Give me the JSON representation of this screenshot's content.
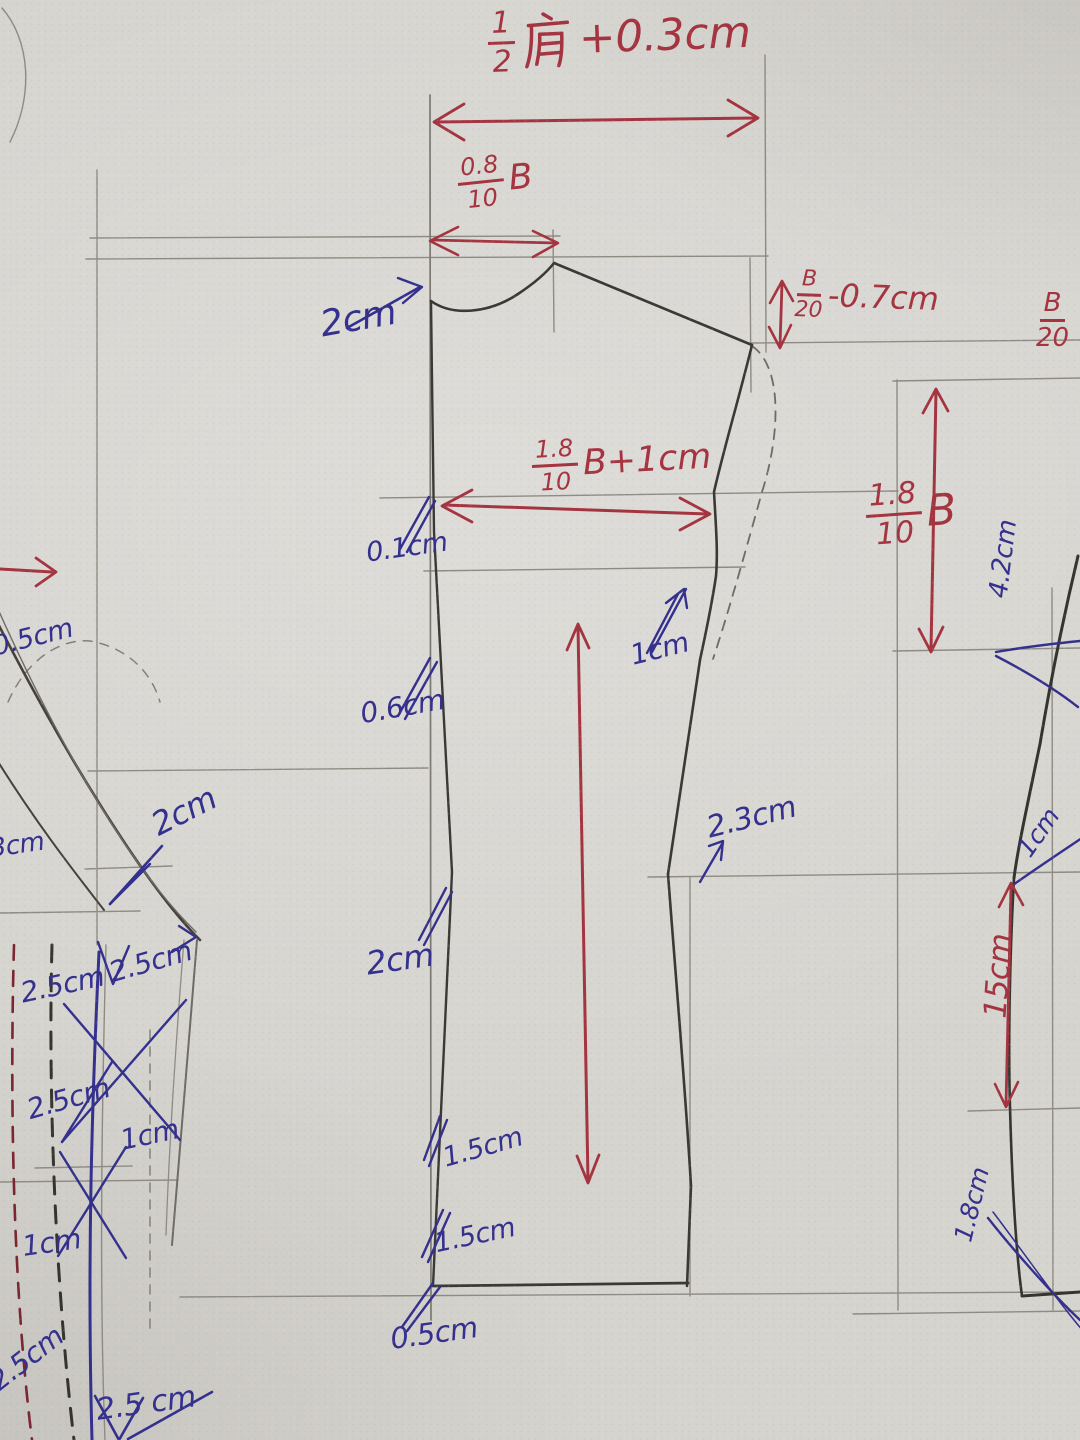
{
  "palette": {
    "paper": "#d6d4cf",
    "pencil_bold": "#3b3936",
    "pencil_light": "#8f8b84",
    "red_ink": "#a43440",
    "blue_ink": "#34308d"
  },
  "formulas": {
    "half_shoulder": {
      "num": "1",
      "den": "2",
      "kanji": "肩",
      "suffix": "+0.3cm"
    },
    "back_neck_rise": {
      "num": "0.8",
      "den": "10",
      "suffix": "B"
    },
    "shoulder_slope": {
      "num": "B",
      "den": "20",
      "suffix": "-0.7cm"
    },
    "edge_partial": {
      "num": "B",
      "den": "20",
      "suffix": ""
    },
    "half_chest": {
      "num": "1.8",
      "den": "10",
      "suffix": "B+1cm"
    },
    "armhole_depth": {
      "num": "1.8",
      "den": "10",
      "suffix": "B"
    }
  },
  "labels": [
    {
      "text": "2cm",
      "ink": "blue"
    },
    {
      "text": "0.1cm",
      "ink": "blue"
    },
    {
      "text": "1cm",
      "ink": "blue"
    },
    {
      "text": "0.6cm",
      "ink": "blue"
    },
    {
      "text": "2cm",
      "ink": "blue"
    },
    {
      "text": "2.3cm",
      "ink": "blue"
    },
    {
      "text": "2cm",
      "ink": "blue"
    },
    {
      "text": "1.5cm",
      "ink": "blue"
    },
    {
      "text": "1.5cm",
      "ink": "blue"
    },
    {
      "text": "0.5cm",
      "ink": "blue"
    },
    {
      "text": "4.2cm",
      "ink": "blue"
    },
    {
      "text": "1cm",
      "ink": "blue"
    },
    {
      "text": "15cm",
      "ink": "red"
    },
    {
      "text": "1.8cm",
      "ink": "blue"
    },
    {
      "text": "0.5cm",
      "ink": "blue"
    },
    {
      "text": "0.3cm",
      "ink": "blue"
    },
    {
      "text": "2.5cm",
      "ink": "blue"
    },
    {
      "text": "2.5cm",
      "ink": "blue"
    },
    {
      "text": "2.5cm",
      "ink": "blue"
    },
    {
      "text": "1cm",
      "ink": "blue"
    },
    {
      "text": "1cm",
      "ink": "blue"
    },
    {
      "text": "2.5cm",
      "ink": "blue"
    },
    {
      "text": "2.5 cm",
      "ink": "blue"
    }
  ]
}
